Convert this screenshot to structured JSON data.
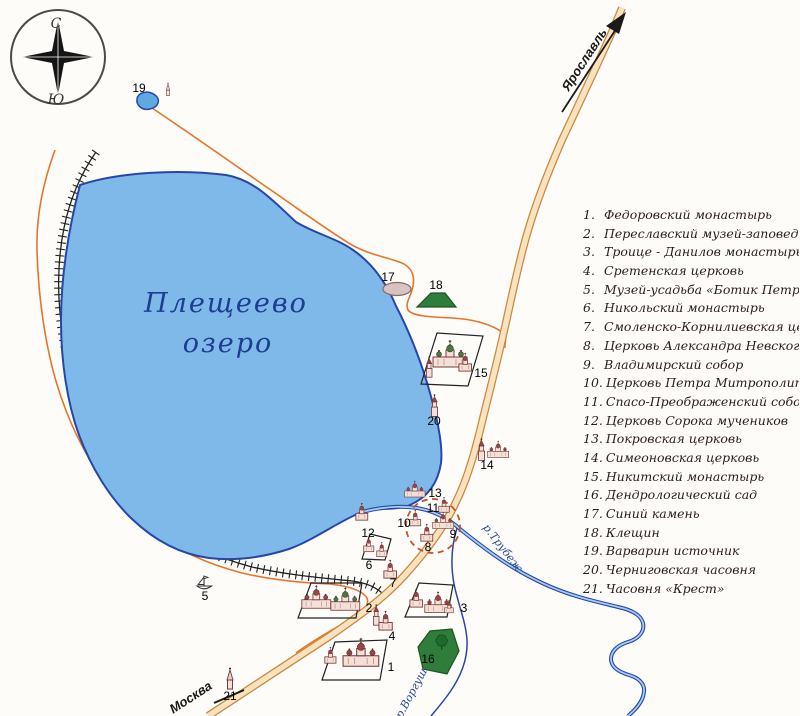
{
  "map": {
    "compass": {
      "north": "С",
      "south": "Ю"
    },
    "lake_label": {
      "line1": "Плещеево",
      "line2": "озеро"
    },
    "roads": {
      "yaroslavl": "Ярославль",
      "moscow": "Москва"
    },
    "rivers": {
      "trubezh": "р.Трубеж",
      "vorgusha": "р.Воргуша"
    },
    "marker_numbers": [
      "1",
      "2",
      "3",
      "4",
      "5",
      "6",
      "7",
      "8",
      "9",
      "10",
      "11",
      "12",
      "13",
      "14",
      "15",
      "16",
      "17",
      "18",
      "19",
      "20",
      "21"
    ]
  },
  "legend": {
    "items": [
      {
        "num": "1.",
        "label": "Федоровский монастырь"
      },
      {
        "num": "2.",
        "label": "Переславский музей-заповедник"
      },
      {
        "num": "3.",
        "label": "Троице - Данилов монастырь"
      },
      {
        "num": "4.",
        "label": "Сретенская церковь"
      },
      {
        "num": "5.",
        "label": "Музей-усадьба  «Ботик Петра I»"
      },
      {
        "num": "6.",
        "label": "Никольский монастырь"
      },
      {
        "num": "7.",
        "label": "Смоленско-Корнилиевская церковь"
      },
      {
        "num": "8.",
        "label": "Церковь Александра Невского"
      },
      {
        "num": "9.",
        "label": "Владимирский собор"
      },
      {
        "num": "10.",
        "label": "Церковь Петра Митрополита"
      },
      {
        "num": "11.",
        "label": "Спасо-Преображенский собор"
      },
      {
        "num": "12.",
        "label": "Церковь Сорока мучеников"
      },
      {
        "num": "13.",
        "label": "Покровская церковь"
      },
      {
        "num": "14.",
        "label": "Симеоновская церковь"
      },
      {
        "num": "15.",
        "label": "Никитский монастырь"
      },
      {
        "num": "16.",
        "label": "Дендрологический сад"
      },
      {
        "num": "17.",
        "label": "Синий камень"
      },
      {
        "num": "18.",
        "label": "Клещин"
      },
      {
        "num": "19.",
        "label": "Варварин источник"
      },
      {
        "num": "20.",
        "label": "Черниговская часовня"
      },
      {
        "num": "21.",
        "label": "Часовня «Крест»"
      }
    ]
  },
  "colors": {
    "lake_fill": "#7fb9e9",
    "lake_outline": "#2647a8",
    "river": "#27479e",
    "road_thin": "#e5752b",
    "road_main_fill": "#f8e3be",
    "road_main_edge": "#c9873f",
    "railway": "#222222",
    "green_area": "#2e7d3a",
    "church_stroke": "#7a3a3a",
    "church_fill": "#f5e0d8",
    "dashed_boundary": "#c2542e"
  }
}
